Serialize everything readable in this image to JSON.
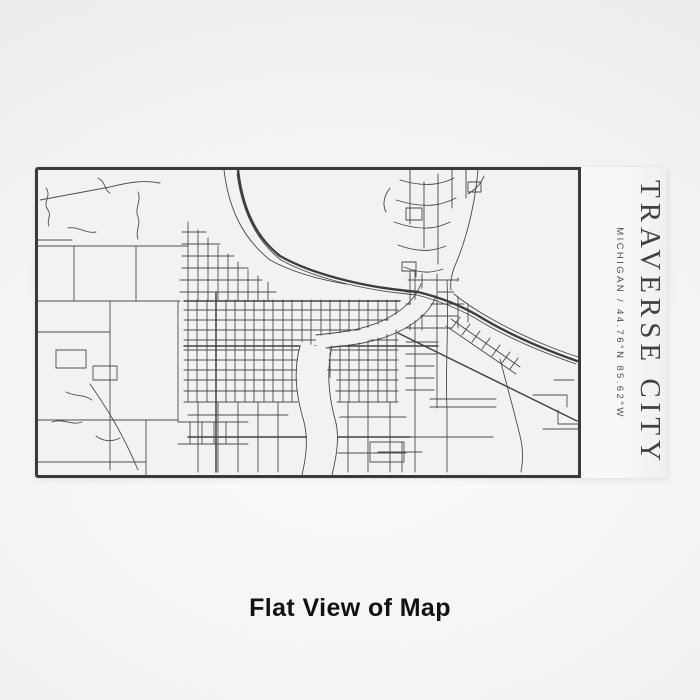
{
  "product": {
    "engraving": {
      "title": "TRAVERSE CITY",
      "subtitle": "MICHIGAN / 44.76°N 85.62°W"
    }
  },
  "caption": "Flat View of Map",
  "colors": {
    "background": "#ececec",
    "panel": "#f8f8f7",
    "map_background": "#f2f2f1",
    "map_border": "#3a3a3c",
    "roads_minor": "#4d4d4d",
    "roads_major": "#3d3d3d",
    "engraving_text": "#3e4245",
    "caption_text": "#121212"
  }
}
